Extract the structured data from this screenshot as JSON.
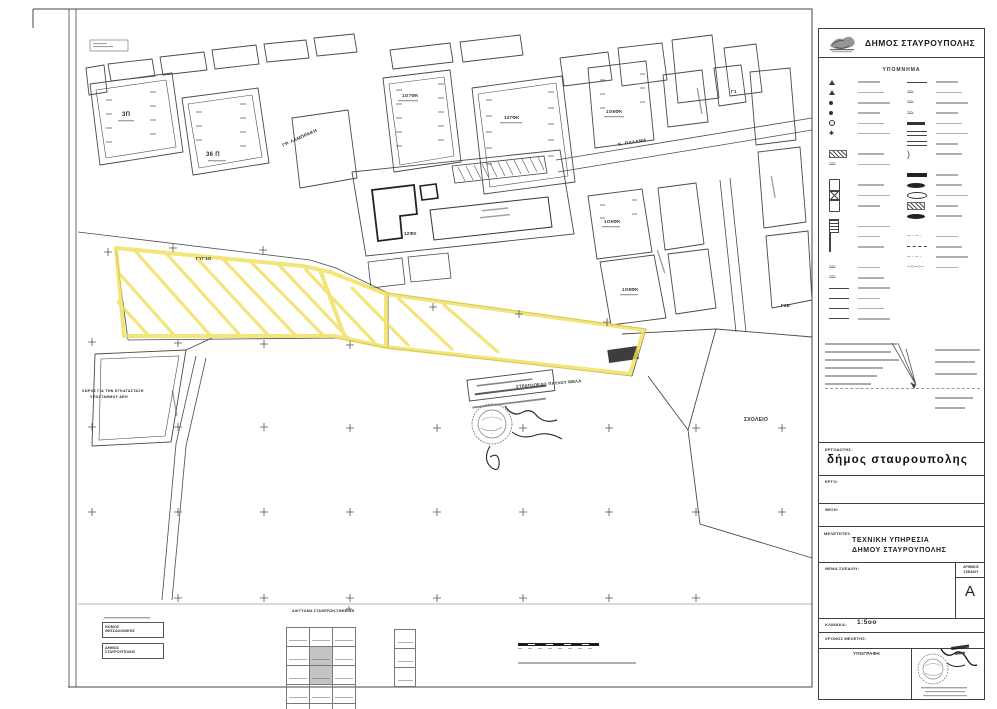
{
  "sheet": {
    "header": {
      "title": "ΔΗΜΟΣ ΣΤΑΥΡΟΥΠΟΛΗΣ"
    },
    "legend_title": "ΥΠΟΜΝΗΜΑ",
    "titleblock": {
      "client_label": "ΕΡΓΟΔΟΤΗΣ:",
      "client_name": "δήμος  σταυρουπολης",
      "project_label": "ΕΡΓΟ:",
      "location_label": "ΘΕΣΗ:",
      "designers_label": "ΜΕΛΕΤΗΤΕΣ:",
      "designer_line1": "ΤΕΧΝΙΚΗ  ΥΠΗΡΕΣΙΑ",
      "designer_line2": "ΔΗΜΟΥ  ΣΤΑΥΡΟΥΠΟΛΗΣ",
      "subject_label": "ΘΕΜΑ ΣΧΕΔΙΟΥ:",
      "number_label_line1": "ΑΡΙΘΜΟΣ",
      "number_label_line2": "ΣΧΕΔΙΟΥ",
      "drawing_number": "A",
      "scale_label": "ΚΛΙΜΑΚΑ:",
      "scale_value": "1:5οο",
      "time_label": "ΧΡΟΝΟΣ  ΜΕΛΕΤΗΣ:",
      "signature_label": "ΥΠΟΓΡΑΦΗ"
    },
    "footer": {
      "box1_line1": "ΝΟΜΟΣ",
      "box1_line2": "ΘΕΣΣΑΛΟΝΙΚΗΣ",
      "box2_line1": "ΔΗΜΟΣ",
      "box2_line2": "ΣΤΑΥΡΟΥΠΟΛΗΣ",
      "table_caption": "ΔΙΚΤΥΩΜΑ ΣΤΑΘΕΡΩΝ ΣΗΜΕΙΩΝ"
    }
  },
  "map": {
    "highlight_color": "#efdf5a",
    "labels": [
      {
        "text": "ΓΡ. ΛΑΜΠΡΑΚΗ",
        "x": 282,
        "y": 144,
        "fs": 4.6,
        "rot": -24
      },
      {
        "text": "Κ. ΠΑΛΑΜΑ",
        "x": 618,
        "y": 143,
        "fs": 4.6,
        "rot": -9
      },
      {
        "text": "ΣΧΟΛΕΙΟ",
        "x": 744,
        "y": 418,
        "fs": 5
      },
      {
        "text": "ΣΤΡΑΤΟΠΕΔΟ ΠΑΥΛΟΥ ΜΕΛΑ",
        "x": 516,
        "y": 385,
        "fs": 4.2,
        "rot": -5
      },
      {
        "text": "ΓΥΓ3Ο",
        "x": 196,
        "y": 257,
        "fs": 4.4
      },
      {
        "text": "ΧΩΡΟΣ ΓΙΑ ΤΗΝ ΕΓΚΑΤΑΣΤΑΣΗ",
        "x": 82,
        "y": 390,
        "fs": 3.6
      },
      {
        "text": "ΥΠΟΣΤΑΘΜΟΥ ΔΕΗ",
        "x": 90,
        "y": 396,
        "fs": 3.6
      },
      {
        "text": "3Π",
        "x": 122,
        "y": 112,
        "fs": 6
      },
      {
        "text": "36 Π",
        "x": 206,
        "y": 152,
        "fs": 6
      },
      {
        "text": "1Ο7ΦΚ",
        "x": 402,
        "y": 94,
        "fs": 4.4
      },
      {
        "text": "127ΦΚ",
        "x": 504,
        "y": 116,
        "fs": 4.4
      },
      {
        "text": "1Ο6ΦΚ",
        "x": 606,
        "y": 110,
        "fs": 4.4
      },
      {
        "text": "1Ο5ΦΚ",
        "x": 604,
        "y": 220,
        "fs": 4.4
      },
      {
        "text": "1Ο8ΦΚ",
        "x": 622,
        "y": 288,
        "fs": 4.4
      },
      {
        "text": "12ΦΚ",
        "x": 404,
        "y": 232,
        "fs": 4.4
      },
      {
        "text": "Γ1",
        "x": 731,
        "y": 90,
        "fs": 4.4
      },
      {
        "text": "Γ2Β",
        "x": 781,
        "y": 304,
        "fs": 4.4
      }
    ]
  },
  "legend": {
    "left_items": [
      {
        "sym": "tri"
      },
      {
        "sym": "tri"
      },
      {
        "sym": "circf"
      },
      {
        "sym": "circf"
      },
      {
        "sym": "circ"
      },
      {
        "sym": "ast"
      },
      {
        "sym": "sp"
      },
      {
        "sym": "hatch"
      },
      {
        "sym": "wavy"
      },
      {
        "sym": "sp"
      },
      {
        "sym": "doc"
      },
      {
        "sym": "crossbox"
      },
      {
        "sym": "doc"
      },
      {
        "sym": "sp"
      },
      {
        "sym": "stack"
      },
      {
        "sym": "excl"
      },
      {
        "sym": "excl"
      },
      {
        "sym": "sp"
      },
      {
        "sym": "wavy"
      },
      {
        "sym": "wavy"
      },
      {
        "sym": "line"
      },
      {
        "sym": "line"
      },
      {
        "sym": "line"
      },
      {
        "sym": "line"
      }
    ],
    "right_items": [
      {
        "sym": "line"
      },
      {
        "sym": "wavy"
      },
      {
        "sym": "wavy"
      },
      {
        "sym": "wavy"
      },
      {
        "sym": "bar"
      },
      {
        "sym": "road"
      },
      {
        "sym": "road"
      },
      {
        "sym": "brace"
      },
      {
        "sym": "sp"
      },
      {
        "sym": "barf"
      },
      {
        "sym": "lensf"
      },
      {
        "sym": "lens"
      },
      {
        "sym": "hatch"
      },
      {
        "sym": "lensf"
      },
      {
        "sym": "sp"
      },
      {
        "sym": "dashdot"
      },
      {
        "sym": "dash"
      },
      {
        "sym": "dashdot"
      },
      {
        "sym": "dashcirc"
      }
    ]
  }
}
